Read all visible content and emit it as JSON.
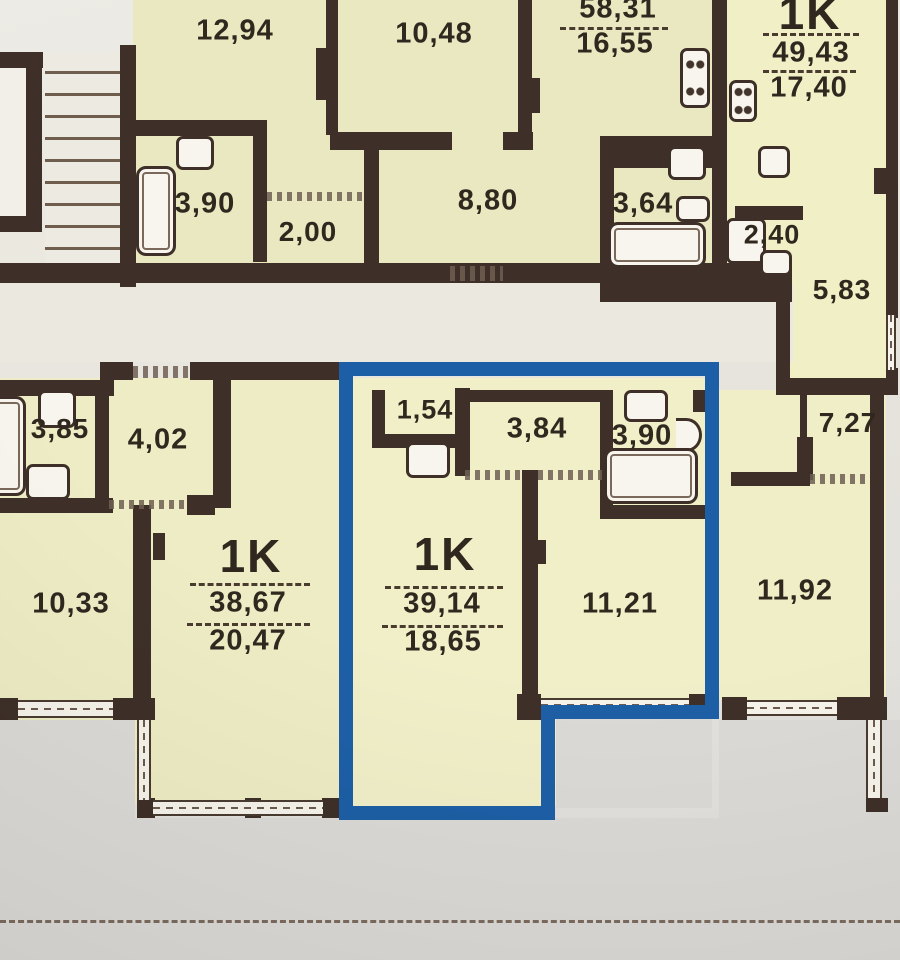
{
  "plan": {
    "colors": {
      "highlight": "#1d5fa6",
      "wall": "#3e3028",
      "room_fill": "#eeecc4"
    },
    "apartments": {
      "apt_58": {
        "total": "58,31",
        "room": "16,55"
      },
      "apt_49": {
        "type": "1K",
        "total": "49,43",
        "living": "17,40"
      },
      "apt_38": {
        "type": "1K",
        "total": "38,67",
        "living": "20,47"
      },
      "apt_39": {
        "type": "1K",
        "total": "39,14",
        "living": "18,65",
        "highlighted": true
      }
    },
    "labels": {
      "r12_94": "12,94",
      "r10_48": "10,48",
      "r8_80": "8,80",
      "r3_90_top": "3,90",
      "r2_00": "2,00",
      "r3_64": "3,64",
      "r2_40": "2,40",
      "r5_83": "5,83",
      "r3_85": "3,85",
      "r4_02": "4,02",
      "r10_33": "10,33",
      "r1_54": "1,54",
      "r3_84": "3,84",
      "r3_90_bath": "3,90",
      "r11_21": "11,21",
      "r7_27": "7,27",
      "r11_92": "11,92"
    }
  }
}
